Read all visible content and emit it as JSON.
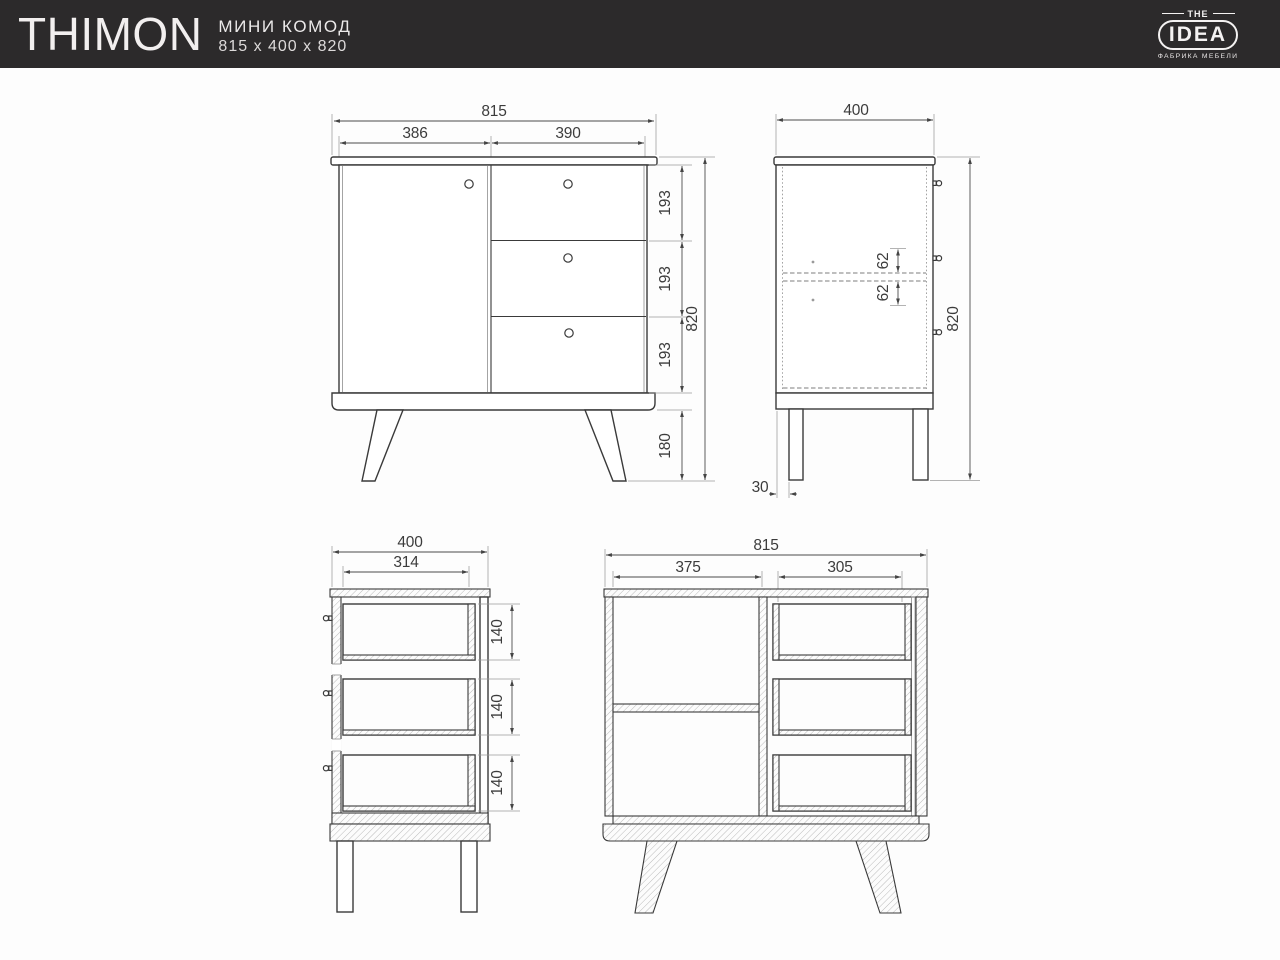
{
  "header": {
    "title": "THIMON",
    "subtitle_line1": "МИНИ КОМОД",
    "subtitle_line2": "815 x 400 x 820",
    "logo": {
      "top": "THE",
      "name": "IDEA",
      "tagline": "ФАБРИКА МЕБЕЛИ"
    }
  },
  "colors": {
    "header_bg": "#2c2a2b",
    "header_text": "#f4f2f2",
    "outline": "#3a3a3a",
    "dimension": "#4c4c4c"
  },
  "views": {
    "front_view": {
      "total_width": "815",
      "door_width": "386",
      "drawers_width": "390",
      "drawer_heights": [
        "193",
        "193",
        "193"
      ],
      "leg_height": "180",
      "total_height": "820"
    },
    "side_view": {
      "depth": "400",
      "handle_offsets": [
        "62",
        "62"
      ],
      "total_height": "820",
      "leg_inset": "30"
    },
    "drawer_section_view": {
      "depth": "400",
      "drawer_depth": "314",
      "drawer_heights": [
        "140",
        "140",
        "140"
      ]
    },
    "front_section_view": {
      "total_width": "815",
      "cabinet_inner_width": "375",
      "drawer_inner_width": "305"
    }
  }
}
